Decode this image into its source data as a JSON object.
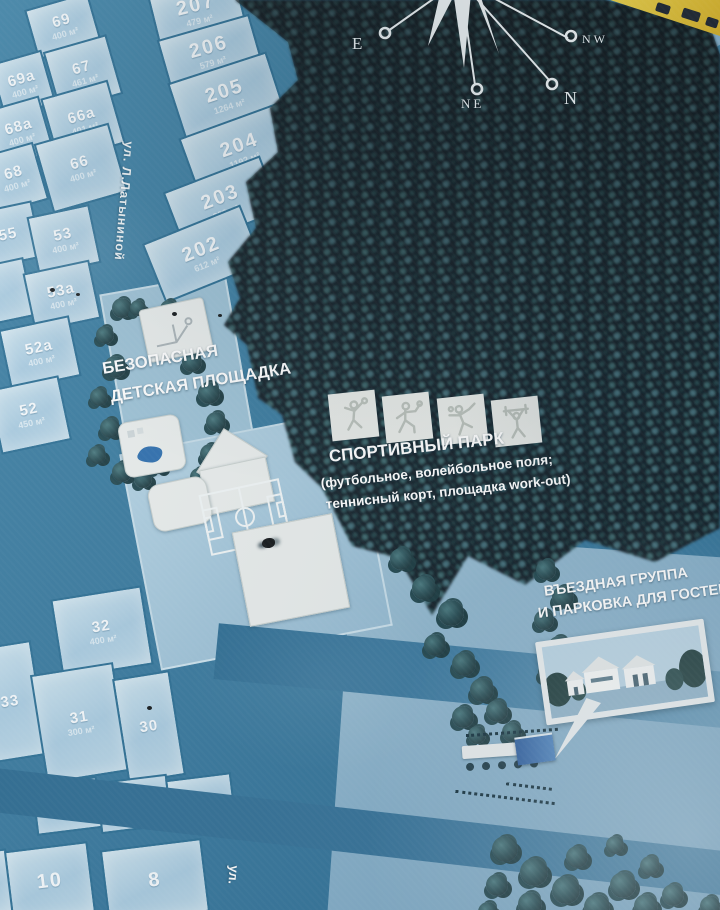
{
  "map": {
    "compass": {
      "e": "E",
      "ne": "NE",
      "n": "N",
      "nw": "NW"
    },
    "labels": {
      "playground": {
        "line1": "БЕЗОПАСНАЯ",
        "line2": "ДЕТСКАЯ ПЛОЩАДКА"
      },
      "sports_park": {
        "title": "СПОРТИВНЫЙ ПАРК",
        "sub1": "(футбольное, волейбольное поля;",
        "sub2": "теннисный корт, площадка work-out)"
      },
      "entrance": {
        "line1": "ВЪЕЗДНАЯ ГРУППА",
        "line2": "И ПАРКОВКА ДЛЯ ГОСТЕЙ"
      }
    },
    "streets": {
      "latynina": "ул. Л.Латыниной",
      "bottom": "ул."
    },
    "sport_icons": [
      "volleyball",
      "tennis-run",
      "tennis",
      "workout"
    ],
    "plots": [
      {
        "num": "69",
        "area": "400 м²",
        "x": 30,
        "y": 0,
        "w": 62,
        "h": 48,
        "rot": -16
      },
      {
        "num": "69а",
        "area": "400 м²",
        "x": -4,
        "y": 56,
        "w": 50,
        "h": 52,
        "rot": -16
      },
      {
        "num": "67",
        "area": "461 м²",
        "x": 50,
        "y": 42,
        "w": 62,
        "h": 58,
        "rot": -16
      },
      {
        "num": "68а",
        "area": "400 м²",
        "x": -8,
        "y": 102,
        "w": 52,
        "h": 56,
        "rot": -16
      },
      {
        "num": "66а",
        "area": "401 м²",
        "x": 48,
        "y": 88,
        "w": 66,
        "h": 62,
        "rot": -16
      },
      {
        "num": "68",
        "area": "400 м²",
        "x": -12,
        "y": 148,
        "w": 50,
        "h": 56,
        "rot": -16
      },
      {
        "num": "66",
        "area": "400 м²",
        "x": 42,
        "y": 132,
        "w": 74,
        "h": 68,
        "rot": -16
      },
      {
        "num": "207",
        "area": "479 м²",
        "x": 152,
        "y": -14,
        "w": 86,
        "h": 44,
        "rot": -14,
        "big": true
      },
      {
        "num": "206",
        "area": "579 м²",
        "x": 162,
        "y": 26,
        "w": 92,
        "h": 48,
        "rot": -16,
        "big": true
      },
      {
        "num": "205",
        "area": "1264 м²",
        "x": 174,
        "y": 66,
        "w": 100,
        "h": 56,
        "rot": -18,
        "big": true
      },
      {
        "num": "204",
        "area": "1192 м²",
        "x": 186,
        "y": 118,
        "w": 106,
        "h": 60,
        "rot": -20,
        "big": true
      },
      {
        "num": "203",
        "area": "803 м²",
        "x": 170,
        "y": 172,
        "w": 100,
        "h": 56,
        "rot": -21,
        "big": true
      },
      {
        "num": "202",
        "area": "612 м²",
        "x": 150,
        "y": 222,
        "w": 102,
        "h": 60,
        "rot": -22,
        "big": true
      },
      {
        "num": "55",
        "area": "",
        "x": -22,
        "y": 206,
        "w": 56,
        "h": 54,
        "rot": -12
      },
      {
        "num": "53",
        "area": "400 м²",
        "x": 32,
        "y": 210,
        "w": 60,
        "h": 56,
        "rot": -12
      },
      {
        "num": "",
        "area": "",
        "x": -24,
        "y": 262,
        "w": 50,
        "h": 56,
        "rot": -12
      },
      {
        "num": "53а",
        "area": "400 м²",
        "x": 28,
        "y": 266,
        "w": 64,
        "h": 56,
        "rot": -12
      },
      {
        "num": "52а",
        "area": "400 м²",
        "x": 4,
        "y": 322,
        "w": 68,
        "h": 58,
        "rot": -12
      },
      {
        "num": "52",
        "area": "450 м²",
        "x": -6,
        "y": 382,
        "w": 68,
        "h": 62,
        "rot": -12
      },
      {
        "num": "32",
        "area": "400 м²",
        "x": 56,
        "y": 592,
        "w": 88,
        "h": 76,
        "rot": -9
      },
      {
        "num": "33",
        "area": "",
        "x": -20,
        "y": 644,
        "w": 56,
        "h": 112,
        "rot": -9
      },
      {
        "num": "31",
        "area": "300 м²",
        "x": 38,
        "y": 668,
        "w": 80,
        "h": 106,
        "rot": -9
      },
      {
        "num": "30",
        "area": "",
        "x": 120,
        "y": 674,
        "w": 54,
        "h": 102,
        "rot": -9
      },
      {
        "num": "",
        "area": "",
        "x": 34,
        "y": 780,
        "w": 62,
        "h": 48,
        "rot": -7
      },
      {
        "num": "",
        "area": "",
        "x": 98,
        "y": 778,
        "w": 68,
        "h": 48,
        "rot": -7
      },
      {
        "num": "",
        "area": "",
        "x": 168,
        "y": 776,
        "w": 62,
        "h": 46,
        "rot": -7
      },
      {
        "num": "",
        "area": "",
        "x": -20,
        "y": 850,
        "w": 26,
        "h": 60,
        "rot": -7
      },
      {
        "num": "10",
        "area": "",
        "x": 8,
        "y": 846,
        "w": 80,
        "h": 68,
        "rot": -7,
        "big": true
      },
      {
        "num": "8",
        "area": "",
        "x": 104,
        "y": 844,
        "w": 98,
        "h": 70,
        "rot": -7,
        "big": true
      }
    ],
    "tree_clumps": [
      [
        112,
        298,
        20
      ],
      [
        96,
        326,
        18
      ],
      [
        104,
        356,
        22
      ],
      [
        90,
        388,
        18
      ],
      [
        100,
        418,
        20
      ],
      [
        88,
        446,
        18
      ],
      [
        112,
        462,
        20
      ],
      [
        134,
        470,
        18
      ],
      [
        150,
        458,
        16
      ],
      [
        160,
        300,
        18
      ],
      [
        130,
        300,
        16
      ],
      [
        182,
        352,
        20
      ],
      [
        198,
        382,
        22
      ],
      [
        206,
        412,
        20
      ],
      [
        200,
        444,
        20
      ],
      [
        190,
        468,
        18
      ],
      [
        214,
        466,
        16
      ],
      [
        390,
        548,
        22
      ],
      [
        412,
        576,
        24
      ],
      [
        438,
        600,
        26
      ],
      [
        424,
        634,
        22
      ],
      [
        452,
        652,
        24
      ],
      [
        470,
        678,
        24
      ],
      [
        452,
        706,
        22
      ],
      [
        486,
        700,
        22
      ],
      [
        502,
        722,
        20
      ],
      [
        468,
        726,
        18
      ],
      [
        536,
        560,
        20
      ],
      [
        552,
        586,
        22
      ],
      [
        534,
        610,
        20
      ],
      [
        548,
        636,
        22
      ],
      [
        538,
        662,
        20
      ],
      [
        546,
        688,
        18
      ],
      [
        492,
        836,
        26
      ],
      [
        520,
        858,
        28
      ],
      [
        552,
        876,
        28
      ],
      [
        584,
        894,
        26
      ],
      [
        518,
        892,
        24
      ],
      [
        486,
        874,
        22
      ],
      [
        610,
        872,
        26
      ],
      [
        634,
        894,
        24
      ],
      [
        566,
        846,
        22
      ],
      [
        478,
        902,
        20
      ],
      [
        640,
        856,
        20
      ],
      [
        662,
        884,
        22
      ],
      [
        700,
        896,
        20
      ],
      [
        606,
        836,
        18
      ]
    ],
    "fly_specks": [
      [
        50,
        288,
        5
      ],
      [
        76,
        293,
        4
      ],
      [
        172,
        312,
        5
      ],
      [
        218,
        314,
        4
      ],
      [
        262,
        538,
        13
      ],
      [
        147,
        706,
        5
      ]
    ],
    "colors": {
      "road": "#3b7ca0",
      "plot_fill": "#b3d2e2",
      "plot_border": "#2d6f94",
      "forest": "#15262b",
      "field": "#8fb6ce",
      "label_text": "#ffffff",
      "court_white": "#e9edec",
      "gate_blue": "#3d71ae",
      "sign_yellow": "#e0c23a"
    }
  }
}
